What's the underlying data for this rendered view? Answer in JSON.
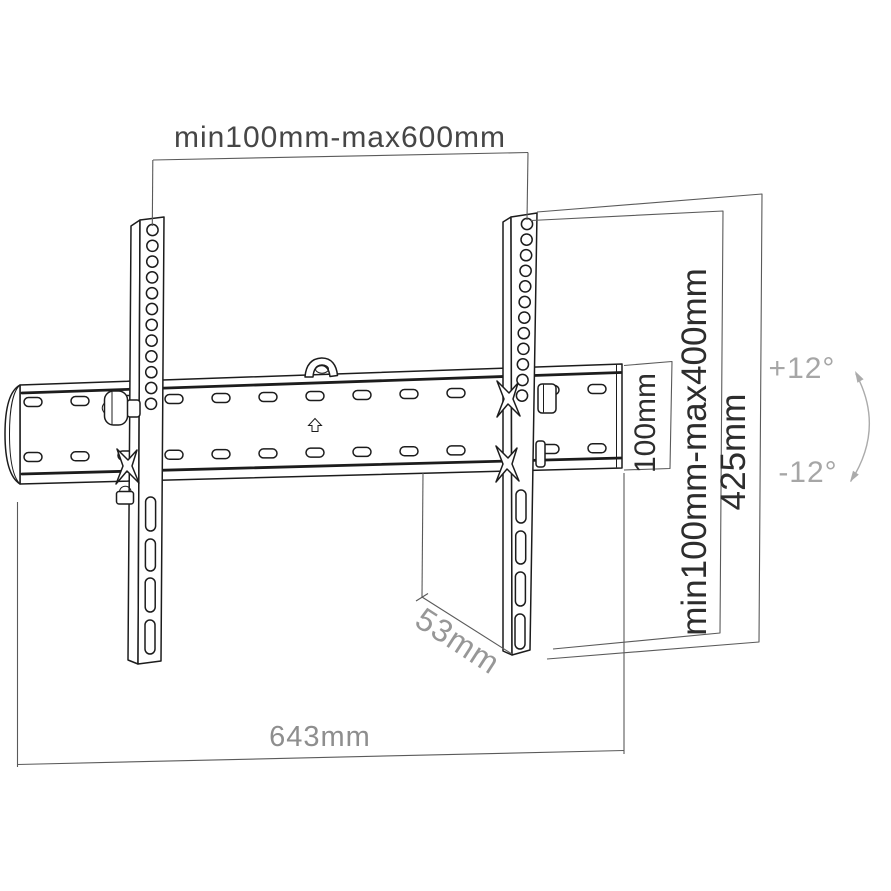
{
  "diagram": {
    "type": "technical-dimension-drawing",
    "subject": "tilting TV wall mount bracket",
    "dimensions": {
      "top_width_range": "min100mm-max600mm",
      "plate_height": "100mm",
      "vesa_vertical_range": "min100mm-max400mm",
      "arm_height": "425mm",
      "depth": "53mm",
      "total_width": "643mm",
      "tilt_up": "+12°",
      "tilt_down": "-12°"
    },
    "icons": {
      "up_arrow": "outlined up arrow on mounting plate",
      "hook": "center hanging hook tab",
      "padlock": "safety lock on left arm",
      "tilt_arc": "double-headed curved arrow"
    },
    "colors": {
      "drawing_line": "#1c1c1c",
      "dimension_line": "#5a5a5a",
      "dimension_text_dark": "#2d2d2d",
      "dimension_text_gray": "#8e8e8e",
      "tilt_annotation": "#a6a6a6",
      "background": "#ffffff"
    }
  }
}
